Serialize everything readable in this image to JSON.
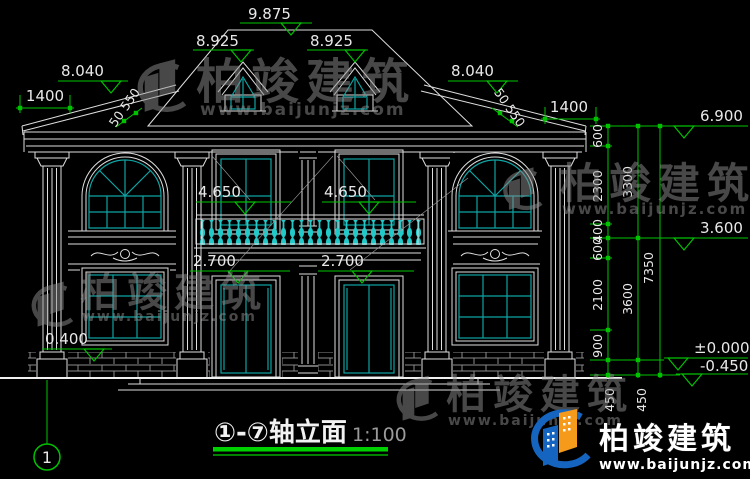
{
  "brand": {
    "name": "柏竣建筑",
    "site": "www.baijunjz.com"
  },
  "title_block": {
    "axis_bubble": "1",
    "title": "①-⑦轴立面",
    "scale": "1:100"
  },
  "elevations": {
    "ridge": "9.875",
    "dormer_left": "8.925",
    "dormer_right": "8.925",
    "wing_left": "8.040",
    "wing_right": "8.040",
    "eave": "6.900",
    "sill2_left": "4.650",
    "sill2_right": "4.650",
    "floor2": "3.600",
    "door_left": "2.700",
    "door_right": "2.700",
    "sill1": "0.400",
    "zero": "±0.000",
    "grade": "-0.450"
  },
  "dimensions": {
    "overhang_left": "1400",
    "overhang_right": "1400",
    "eave_detail_left": "50 550",
    "eave_detail_right": "50 550",
    "chain_inner": [
      "600",
      "2300",
      "400",
      "600",
      "2100",
      "900"
    ],
    "chain_middle": [
      "3300",
      "3600"
    ],
    "total_height": "7350",
    "steps": [
      "450",
      "450"
    ]
  },
  "colors": {
    "background": "#000000",
    "line": "#dedede",
    "glass": "#0fa3a3",
    "baluster": "#21c9c9",
    "dimension": "#00c300",
    "title_underline": "#00d000",
    "watermark": "#8f8f8f",
    "logo_blue": "#1565c0",
    "logo_orange": "#f59a1a"
  }
}
